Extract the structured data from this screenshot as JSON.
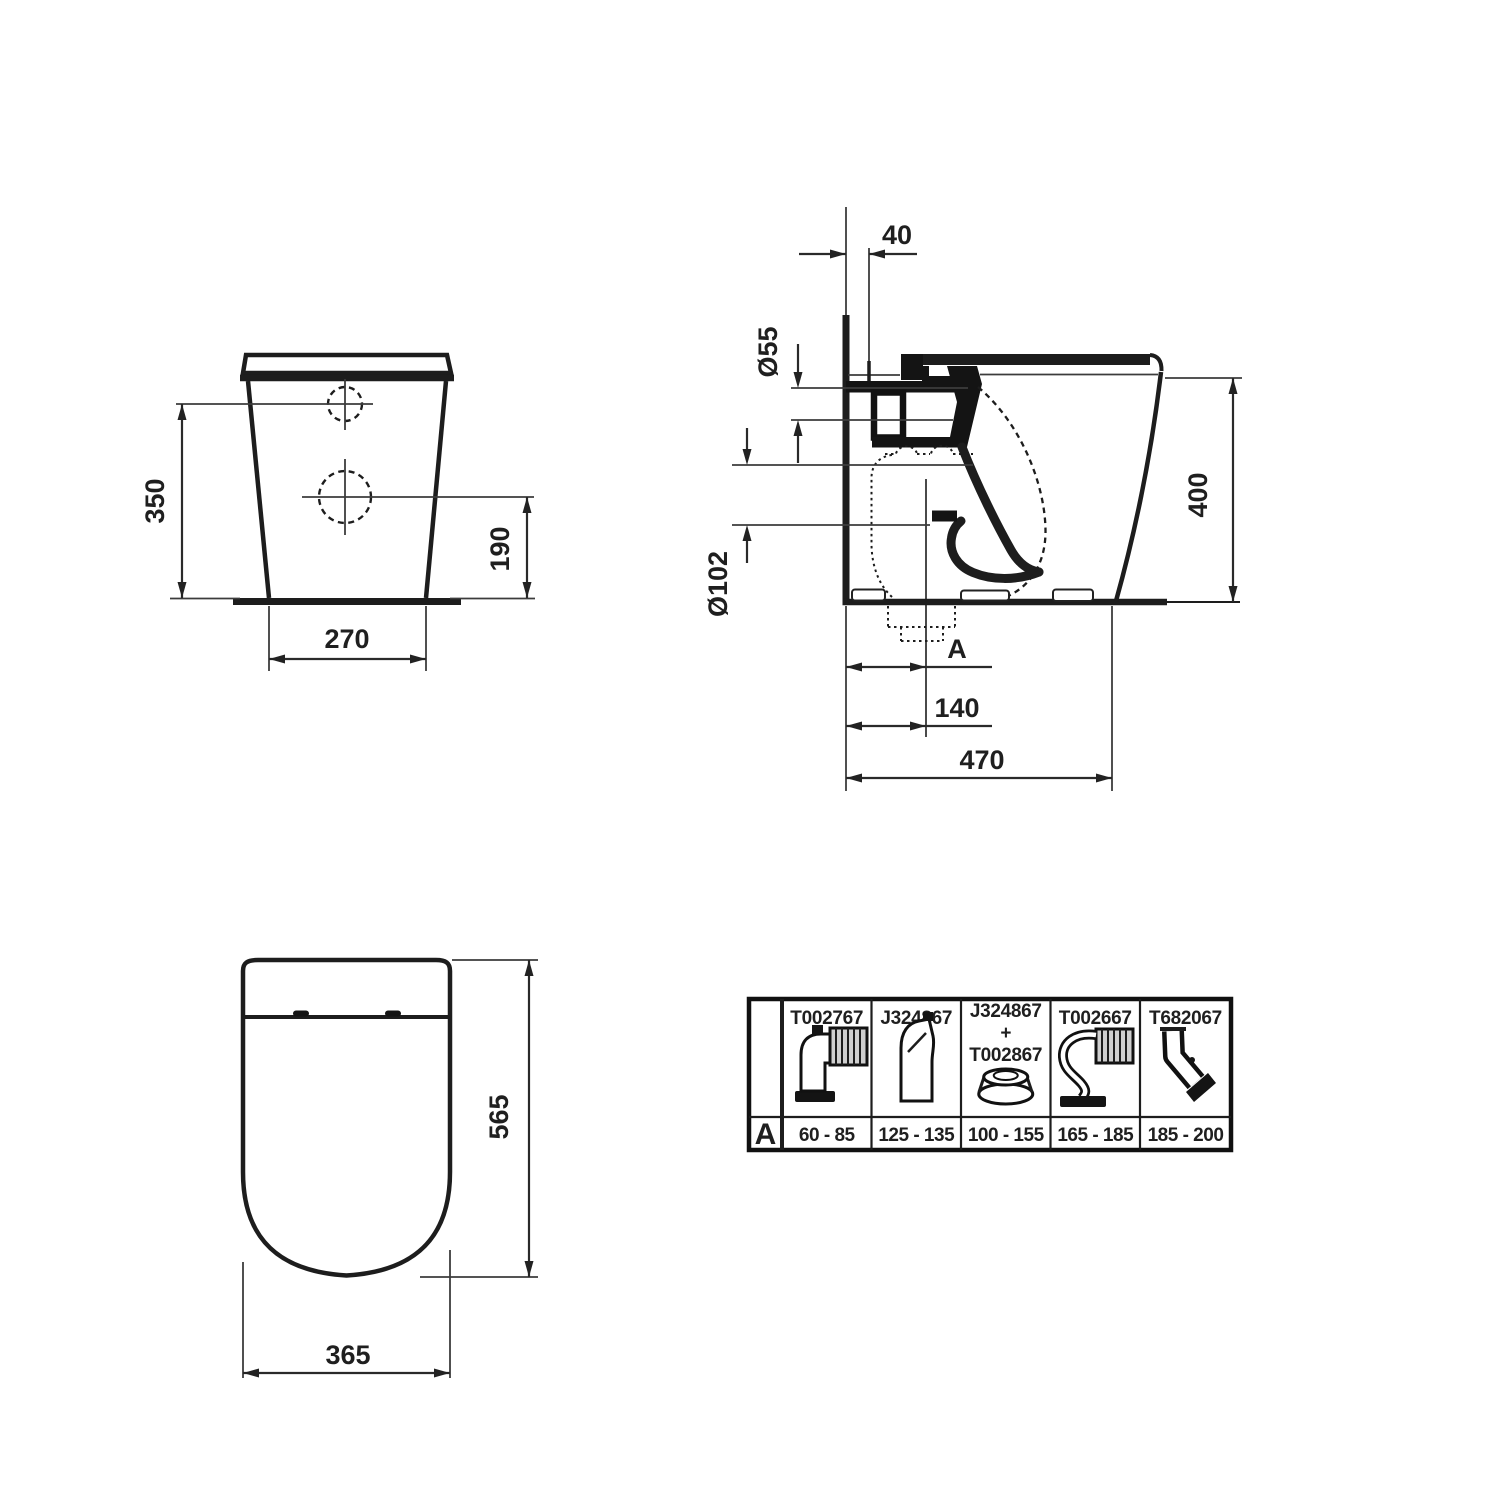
{
  "front_view": {
    "dim_overall_height": "350",
    "dim_outlet_height": "190",
    "dim_base_width": "270"
  },
  "side_view": {
    "dim_wall_gap": "40",
    "dim_inlet_diameter": "Ø55",
    "dim_outlet_diameter": "Ø102",
    "dim_height": "400",
    "dim_outlet_distance_label": "A",
    "dim_outlet_offset": "140",
    "dim_depth": "470"
  },
  "top_view": {
    "dim_length": "565",
    "dim_width": "365"
  },
  "accessory_table": {
    "row_label": "A",
    "plus_sign": "+",
    "columns": [
      {
        "part_number": "T002767",
        "range": "60 - 85",
        "icon": "elbow-with-corrugated-hose-icon"
      },
      {
        "part_number": "J324867",
        "range": "125 - 135",
        "icon": "offset-bend-connector-icon"
      },
      {
        "part_number": "J324867",
        "part_number_2": "T002867",
        "range": "100 - 155",
        "icon": "flange-adapter-icon"
      },
      {
        "part_number": "T002667",
        "range": "165 - 185",
        "icon": "s-bend-with-corrugated-hose-icon"
      },
      {
        "part_number": "T682067",
        "range": "185 - 200",
        "icon": "angled-connector-icon"
      }
    ]
  }
}
